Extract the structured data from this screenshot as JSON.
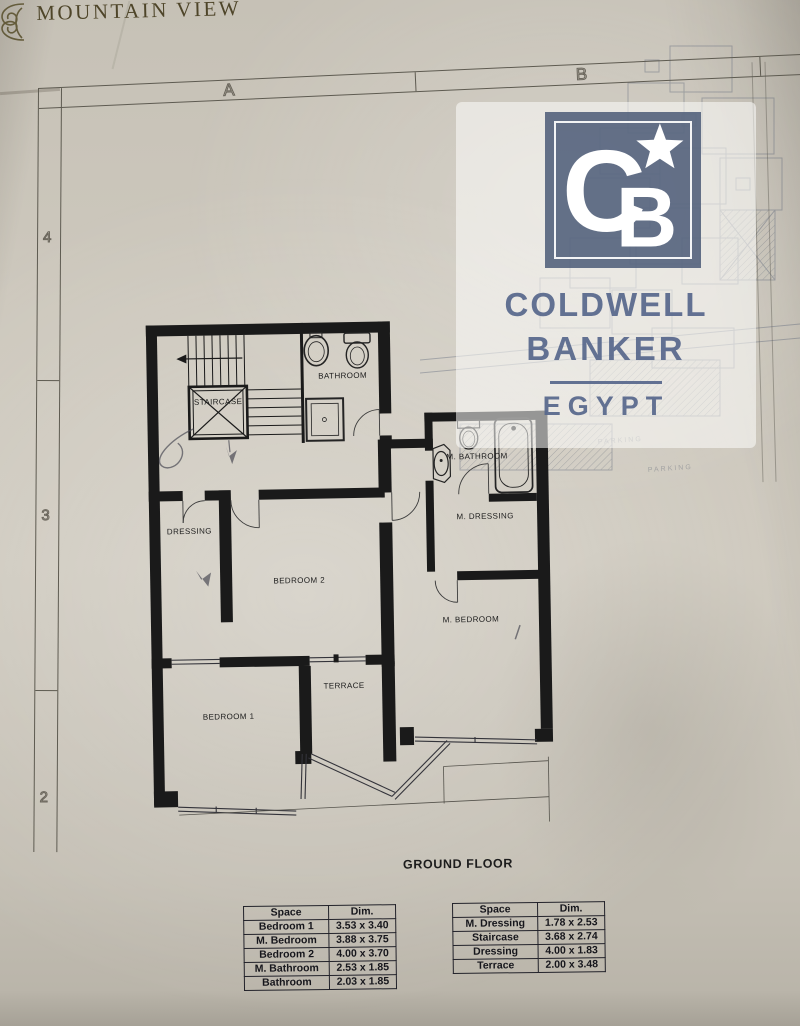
{
  "brand": {
    "name": "MOUNTAIN VIEW"
  },
  "sheet": {
    "grid_columns": [
      "A",
      "B"
    ],
    "grid_rows": [
      "4",
      "3",
      "2"
    ]
  },
  "watermark": {
    "monogram_c": "C",
    "monogram_b": "B",
    "star": "★",
    "line1": "COLDWELL",
    "line2": "BANKER",
    "country": "EGYPT",
    "brand_blue": "#495875",
    "text_blue": "#5a6a8d"
  },
  "plan": {
    "floor_title": "GROUND FLOOR",
    "rooms": [
      {
        "label": "STAIRCASE"
      },
      {
        "label": "BATHROOM"
      },
      {
        "label": "M. BATHROOM"
      },
      {
        "label": "M. DRESSING"
      },
      {
        "label": "DRESSING"
      },
      {
        "label": "BEDROOM 2"
      },
      {
        "label": "M. BEDROOM"
      },
      {
        "label": "BEDROOM 1"
      },
      {
        "label": "TERRACE"
      }
    ]
  },
  "site_plan": {
    "labels": [
      "PARKING",
      "PARKING"
    ]
  },
  "dimension_tables": [
    {
      "headers": [
        "Space",
        "Dim."
      ],
      "rows": [
        [
          "Bedroom 1",
          "3.53 x 3.40"
        ],
        [
          "M. Bedroom",
          "3.88 x 3.75"
        ],
        [
          "Bedroom 2",
          "4.00 x 3.70"
        ],
        [
          "M. Bathroom",
          "2.53 x 1.85"
        ],
        [
          "Bathroom",
          "2.03 x 1.85"
        ]
      ]
    },
    {
      "headers": [
        "Space",
        "Dim."
      ],
      "rows": [
        [
          "M. Dressing",
          "1.78 x 2.53"
        ],
        [
          "Staircase",
          "3.68 x 2.74"
        ],
        [
          "Dressing",
          "4.00 x 1.83"
        ],
        [
          "Terrace",
          "2.00 x 3.48"
        ]
      ]
    }
  ]
}
